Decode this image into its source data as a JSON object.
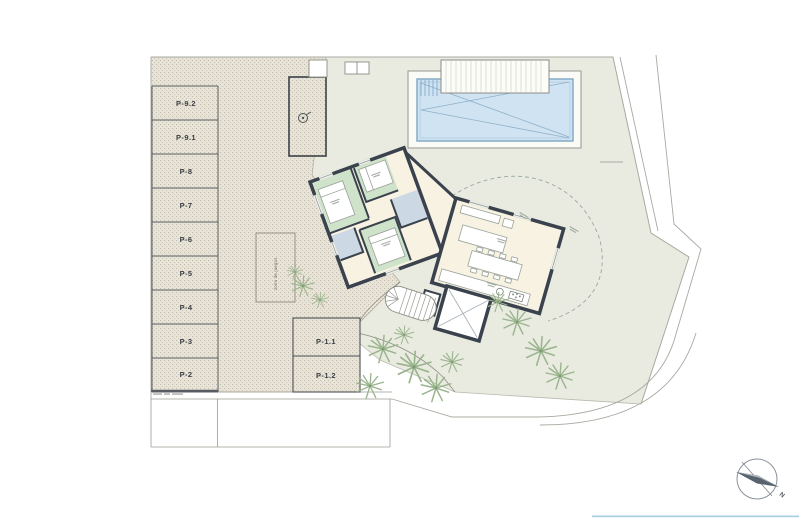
{
  "plan": {
    "type": "architectural-site-plan",
    "parking": {
      "stalls": [
        {
          "label": "P-9.2"
        },
        {
          "label": "P-9.1"
        },
        {
          "label": "P-8"
        },
        {
          "label": "P-7"
        },
        {
          "label": "P-6"
        },
        {
          "label": "P-5"
        },
        {
          "label": "P-4"
        },
        {
          "label": "P-3"
        },
        {
          "label": "P-2"
        }
      ],
      "island_stalls": [
        {
          "label": "P-1.1"
        },
        {
          "label": "P-1.2"
        }
      ]
    },
    "annotations": {
      "service_area": "zona de juegos",
      "north": "N"
    },
    "colors": {
      "walls": "#39424d",
      "bedroom_floor": "#cfe3cb",
      "bath_floor": "#ccd8e4",
      "living_floor": "#f7f2e2",
      "pool_water": "#cfe3f3",
      "pool_edge": "#7ea6c4",
      "lawn": "#e9ebe1",
      "paving": "#e9e4d9",
      "vegetation": "#9ab58d",
      "frame_accent": "#a8cfe0"
    }
  }
}
